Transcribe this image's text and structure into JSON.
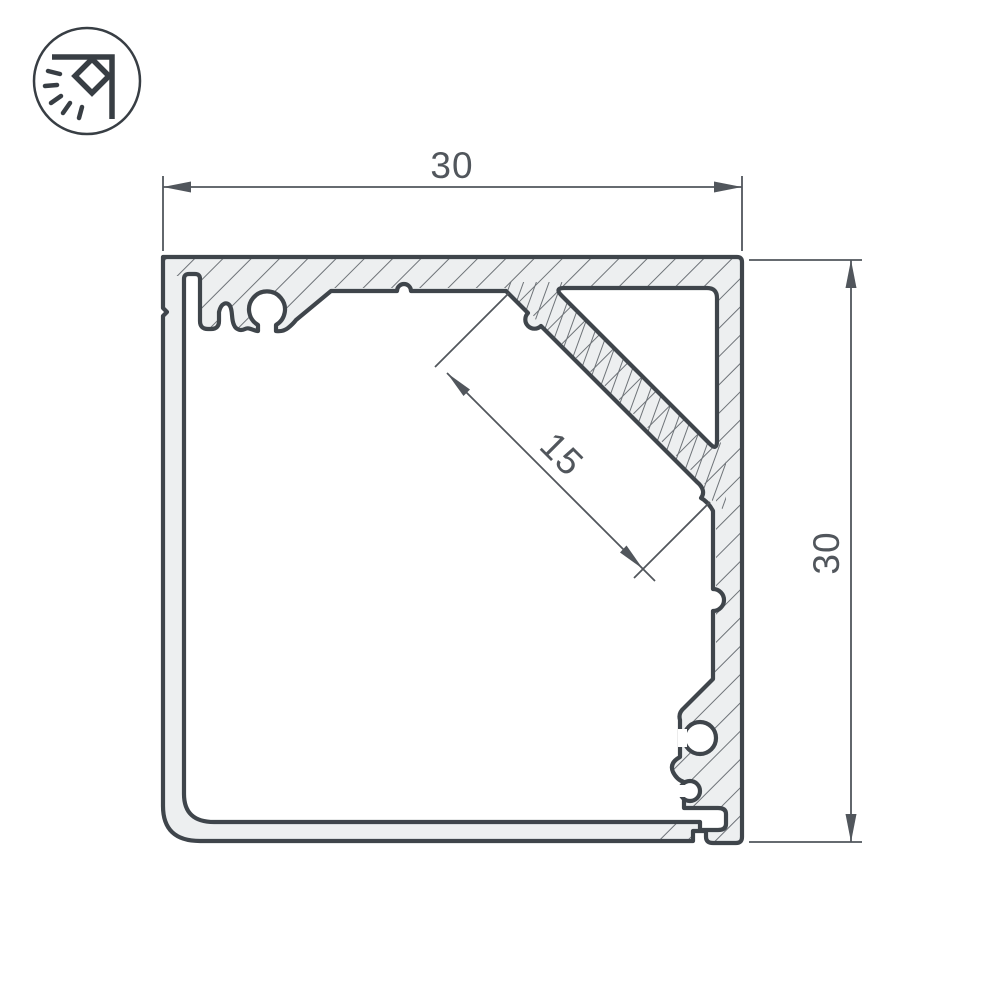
{
  "drawing": {
    "kind": "technical-cross-section",
    "subject": "square LED profile with 45-degree corner mounting face",
    "dimension_labels": {
      "width": "30",
      "height": "30",
      "led_face": "15"
    },
    "logo": {
      "icon": "corner-lamp-icon",
      "description": "circle badge with corner bracket lamp and light rays"
    },
    "colors": {
      "background": "#ffffff",
      "ink": "#3f454b",
      "hatch_line": "#6e7378",
      "metal_fill": "#edeff0",
      "dimension_ink": "#51565c",
      "logo_ink": "#383e44"
    }
  }
}
